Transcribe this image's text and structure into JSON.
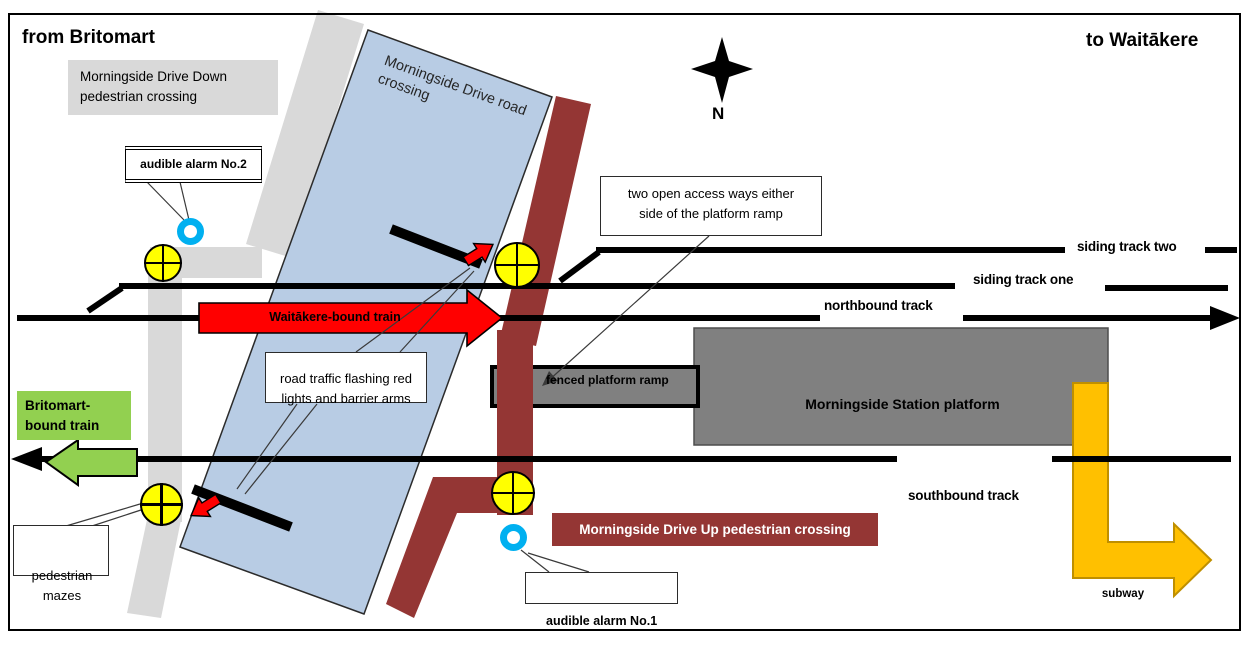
{
  "header": {
    "from": "from Britomart",
    "to": "to Waitākere"
  },
  "compass": {
    "label": "N"
  },
  "crossings": {
    "down": "Morningside Drive Down pedestrian crossing",
    "road": "Morningside Drive road crossing",
    "up": "Morningside Drive Up pedestrian crossing"
  },
  "alarms": {
    "no1": "audible alarm No.1",
    "no2": "audible alarm No.2"
  },
  "callouts": {
    "access_ways": "two open access ways either side of the platform ramp",
    "road_traffic": "road traffic flashing red lights and barrier arms",
    "pedestrian_mazes": "pedestrian mazes"
  },
  "station": {
    "platform": "Morningside Station platform",
    "ramp": "fenced platform ramp",
    "subway": "subway"
  },
  "tracks": {
    "siding_two": "siding track two",
    "siding_one": "siding track one",
    "northbound": "northbound track",
    "southbound": "southbound track"
  },
  "trains": {
    "waitakere": "Waitākere-bound train",
    "britomart": "Britomart-bound train"
  },
  "colors": {
    "road_gray": "#D9D9D9",
    "crossing_blue": "#B8CCE4",
    "crossing_maroon": "#943634",
    "platform_gray": "#808080",
    "signal_yellow": "#FFFF00",
    "alarm_blue": "#00B0F0",
    "train_red": "#FF0000",
    "train_green": "#92D050",
    "subway_orange": "#FFC000"
  }
}
